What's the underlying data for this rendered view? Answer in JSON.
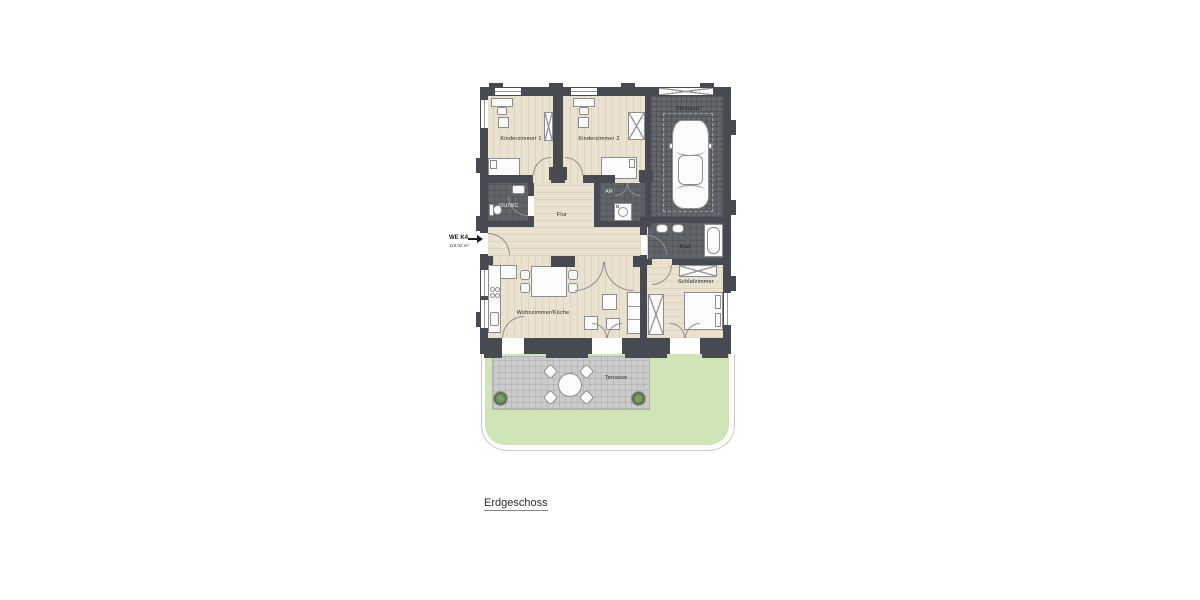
{
  "title": "Erdgeschoss",
  "unit": {
    "code": "WE K4",
    "area": "119.02 m²"
  },
  "rooms": {
    "kinderzimmer1": "Kinderzimmer 1",
    "kinderzimmer2": "Kinderzimmer 2",
    "stellplatz": "Stellplatz",
    "duwc": "DU/WC",
    "flur": "Flur",
    "ar": "AR",
    "bad": "Bad",
    "schlafzimmer": "Schlafzimmer",
    "wohnkueche": "Wohnzimmer/Küche",
    "terrasse": "Terrasse"
  },
  "colors": {
    "wall": "#474b51",
    "wood_floor": "#eae2cf",
    "dark_room_floor": "#5f6468",
    "parking_floor": "#63676c",
    "terrace_paving": "#cbcbcb",
    "lawn": "#cfe5b5"
  }
}
